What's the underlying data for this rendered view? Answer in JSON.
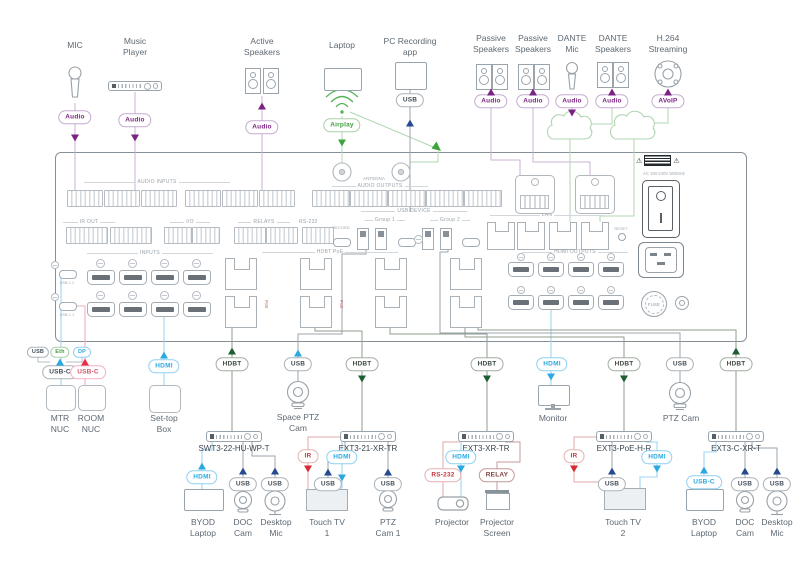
{
  "colors": {
    "audio_accent": "#7b2382",
    "airplay_accent": "#3f9e3f",
    "hdmi_accent": "#2aa9e1",
    "hdbt_accent": "#1d5e33",
    "usb_accent": "#27498f",
    "ir_accent": "#d42b35"
  },
  "top_devices": {
    "mic": {
      "label": "MIC",
      "pill": "Audio"
    },
    "music_player": {
      "label": "Music Player",
      "pill": "Audio"
    },
    "active_speakers": {
      "label": "Active Speakers",
      "pill": "Audio"
    },
    "laptop": {
      "label": "Laptop",
      "pill": "Airplay"
    },
    "pc_recording": {
      "label": "PC Recording app",
      "pill": "USB"
    },
    "passive_speakers_1": {
      "label": "Passive Speakers",
      "pill": "Audio"
    },
    "passive_speakers_2": {
      "label": "Passive Speakers",
      "pill": "Audio"
    },
    "dante_mic": {
      "label": "DANTE Mic",
      "pill": "Audio"
    },
    "dante_speakers": {
      "label": "DANTE Speakers",
      "pill": "Audio"
    },
    "h264": {
      "label": "H.264 Streaming",
      "pill": "AVoIP"
    }
  },
  "panel": {
    "audio_inputs": "AUDIO INPUTS",
    "antenna": "ANTENNA",
    "audio_outputs": "AUDIO OUTPUTS",
    "ir_out": "IR OUT",
    "io": "I/O",
    "relays": "RELAYS",
    "rs232": "RS-232",
    "record": "RECORD",
    "usb_device": "USB DEVICE",
    "group1": "Group 1",
    "group2": "Group 2",
    "lan": "LAN",
    "reset": "RESET",
    "inputs": "INPUTS",
    "usbc1": "USB-C 1",
    "usbc2": "USB-C 2",
    "hdbt": "HDBT PoE",
    "poe": "PoE",
    "hdmi_outputs": "HDMI OUTPUTS",
    "ac": "AC 100-240V 50/60Hz",
    "fuse": "FUSE",
    "warning_icon": "⚠"
  },
  "bottom": {
    "proto_pills": {
      "usb": "USB",
      "eth": "Eth",
      "dp": "DP"
    },
    "mtr_nuc": {
      "label": "MTR NUC",
      "pill": "USB-C"
    },
    "room_nuc": {
      "label": "ROOM NUC",
      "pill": "USB-C"
    },
    "settop": {
      "label": "Set-top Box",
      "pill": "HDMI"
    },
    "swt3": {
      "name": "SWT3-22-HU-WP-T",
      "pill": "HDBT"
    },
    "space_ptz": {
      "label": "Space PTZ Cam",
      "pill": "USB"
    },
    "ext21": {
      "name": "EXT3-21-XR-TR",
      "pill": "HDBT"
    },
    "byod1": {
      "label": "BYOD Laptop",
      "pill": "HDMI"
    },
    "doccam1": {
      "label": "DOC Cam",
      "pill": "USB"
    },
    "deskmic1": {
      "label": "Desktop Mic",
      "pill": "USB"
    },
    "touchtv1": {
      "label": "Touch TV 1",
      "ir": "IR",
      "hdmi": "HDMI",
      "usb": "USB"
    },
    "ptzcam1": {
      "label": "PTZ Cam 1",
      "pill": "USB"
    },
    "extxr": {
      "name": "EXT3-XR-TR",
      "pill": "HDBT",
      "rs232": "RS-232",
      "hdmi": "HDMI",
      "relay": "RELAY"
    },
    "projector": {
      "label": "Projector"
    },
    "projscreen": {
      "label": "Projector Screen"
    },
    "monitor": {
      "label": "Monitor",
      "pill": "HDMI"
    },
    "extpoe": {
      "name": "EXT3-PoE-H-R",
      "pill": "HDBT",
      "ir": "IR",
      "hdmi": "HDMI",
      "usb": "USB"
    },
    "touchtv2": {
      "label": "Touch TV 2"
    },
    "extc": {
      "name": "EXT3-C-XR-T",
      "pill": "HDBT"
    },
    "byod2": {
      "label": "BYOD Laptop",
      "pill": "USB-C"
    },
    "doccam2": {
      "label": "DOC Cam",
      "pill": "USB"
    },
    "deskmic2": {
      "label": "Desktop Mic",
      "pill": "USB"
    },
    "ptzcam2": {
      "label": "PTZ Cam",
      "pill": "USB"
    }
  }
}
